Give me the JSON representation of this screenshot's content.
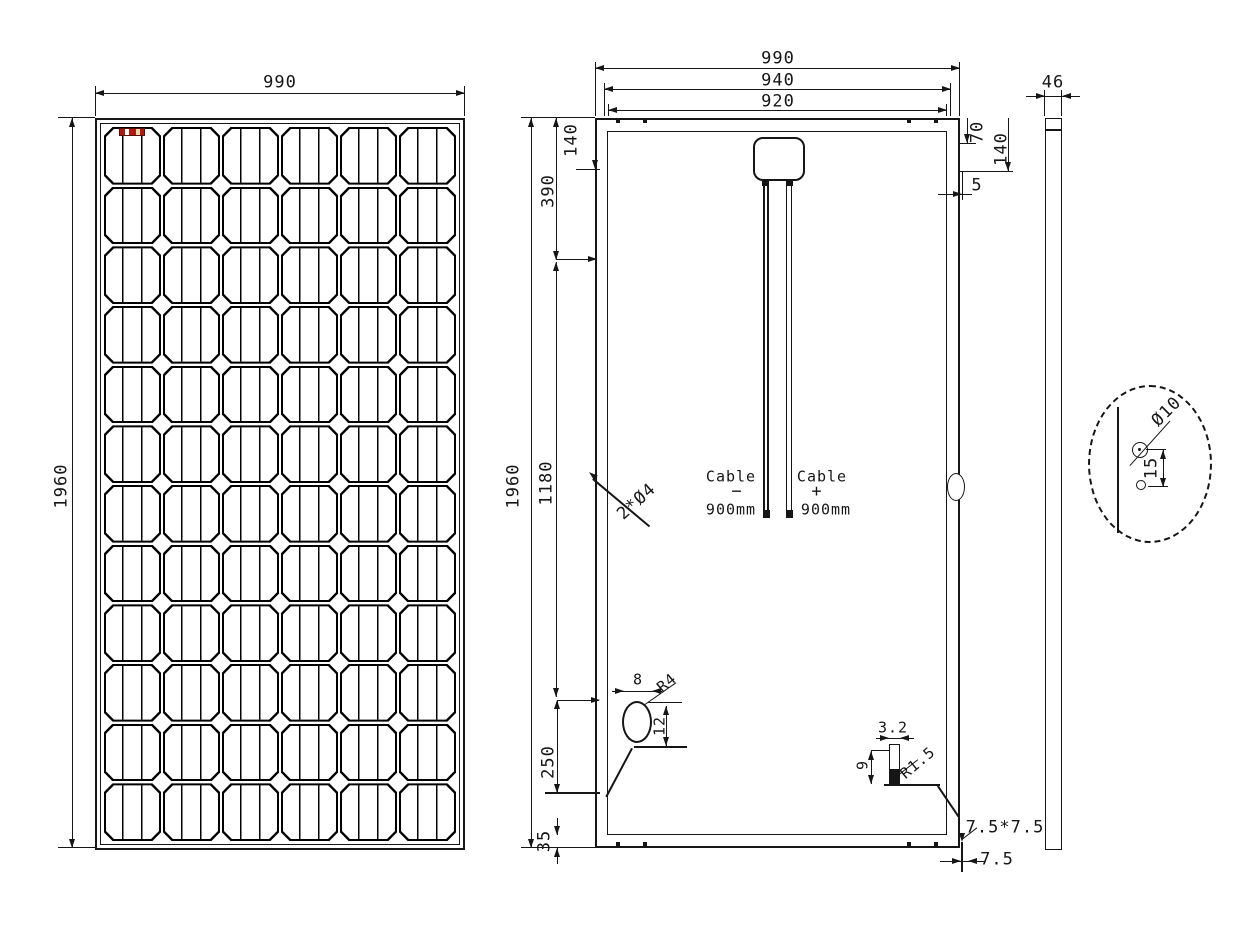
{
  "front": {
    "width": "990",
    "height": "1960",
    "grid": {
      "cols": 6,
      "rows": 12
    }
  },
  "back": {
    "width_outer": "990",
    "width_mount": "940",
    "width_inner": "920",
    "height": "1960",
    "height_inner": "1180",
    "top_left_offset": "390",
    "left_hole_offset": "140",
    "bottom_left_offset": "250",
    "bottom_edge": "35",
    "top_right_offset": "70",
    "right_hole_offset": "140",
    "right_gap": "5",
    "hole_callout": "2*Ø4",
    "cable_neg": {
      "name": "Cable",
      "sign": "−",
      "length": "900mm"
    },
    "cable_pos": {
      "name": "Cable",
      "sign": "+",
      "length": "900mm"
    },
    "mount_slot": {
      "width": "8",
      "radius": "R4",
      "height": "12"
    },
    "notch_slot": {
      "width": "3.2",
      "height": "9",
      "radius": "R1.5"
    },
    "drain": {
      "size": "7.5*7.5",
      "width": "7.5"
    }
  },
  "side": {
    "width": "46"
  },
  "detail": {
    "hole_dia": "Ø10",
    "pitch": "15"
  }
}
